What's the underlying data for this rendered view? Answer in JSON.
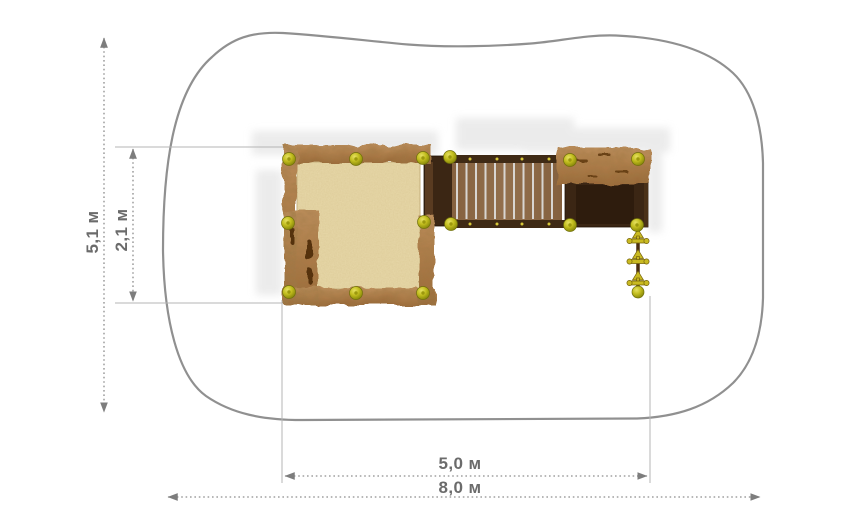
{
  "drawing": {
    "type": "playground-equipment-top-view-plan",
    "units": "м"
  },
  "dimensions": {
    "total_height": {
      "label": "5,1 м"
    },
    "inner_height": {
      "label": "2,1 м"
    },
    "structure_width": {
      "label": "5,0 м"
    },
    "total_width": {
      "label": "8,0 м"
    }
  },
  "elements": {
    "safety_zone": "safety zone outline",
    "sandbox": "sandbox with rough timber frame",
    "sand": "sand surface",
    "bridge": "plank bridge",
    "platform_left": "left platform",
    "platform_right": "right platform with timber bar",
    "climbing_rope": "climbing rope with hand holds",
    "knobs": "yellow cap knobs"
  },
  "colors": {
    "outline": "#909090",
    "dim_line": "#8d8d8d",
    "ext_line": "#b5b5b5",
    "label_text": "#6b6b6b",
    "sand": "#e7d8a9",
    "wood_light": "#b5834f",
    "wood_dark": "#7c4f27",
    "platform": "#3b2614",
    "plank": "#8f6b49",
    "plank_gap": "#d8d5d1",
    "beam": "#3f2a15",
    "knob_bright": "#c9c426",
    "knob_dark": "#8a8a06",
    "bg": "#ffffff"
  }
}
